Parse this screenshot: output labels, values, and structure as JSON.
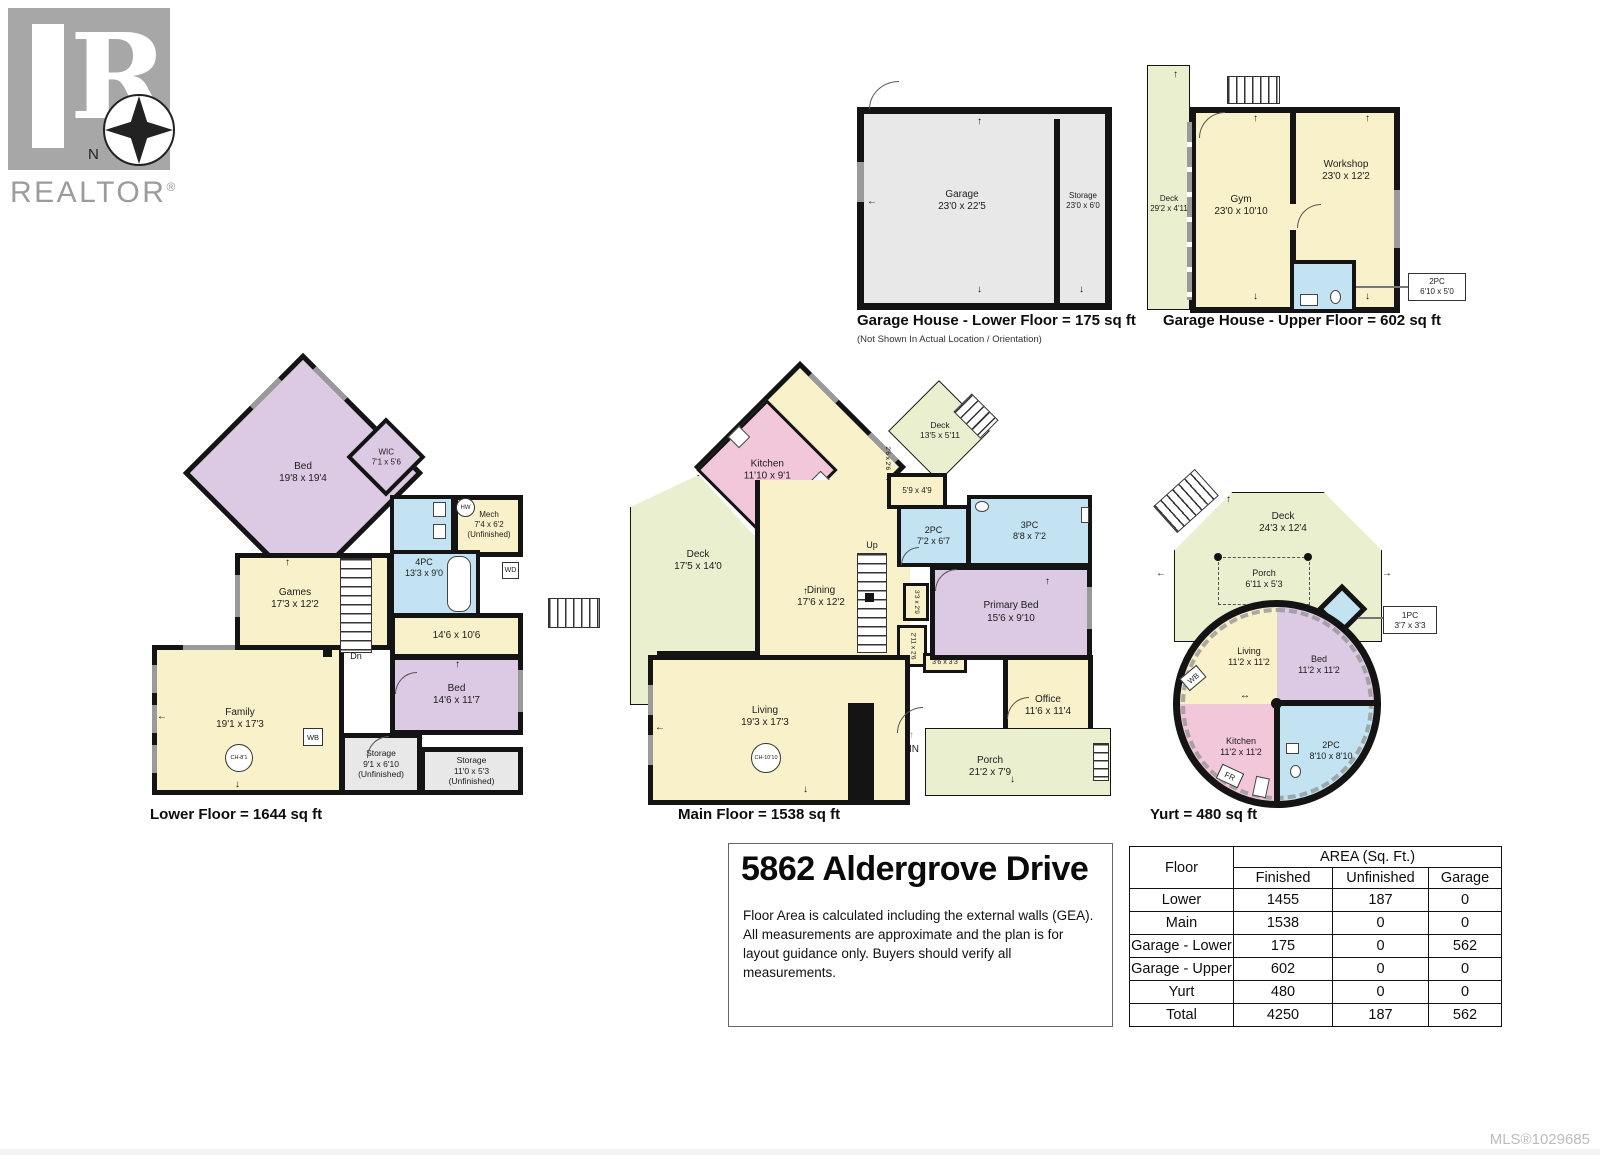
{
  "logo": {
    "brand": "REALTOR",
    "reg": "®",
    "north": "N"
  },
  "plans": {
    "garage_lower": {
      "caption": "Garage House - Lower Floor = 175 sq ft",
      "note": "(Not Shown In Actual Location / Orientation)",
      "rooms": [
        {
          "name": "Garage",
          "dims": "23'0 x 22'5"
        },
        {
          "name": "Storage",
          "dims": "23'0 x 6'0"
        }
      ]
    },
    "garage_upper": {
      "caption": "Garage House - Upper Floor = 602 sq ft",
      "rooms": [
        {
          "name": "Deck",
          "dims": "29'2 x 4'11"
        },
        {
          "name": "Gym",
          "dims": "23'0 x 10'10"
        },
        {
          "name": "Workshop",
          "dims": "23'0 x 12'2"
        }
      ],
      "callout": {
        "name": "2PC",
        "dims": "6'10 x 5'0"
      }
    },
    "lower": {
      "caption": "Lower Floor = 1644 sq ft",
      "rooms": [
        {
          "name": "Bed",
          "dims": "19'8 x 19'4"
        },
        {
          "name": "WIC",
          "dims": "7'1 x 5'6"
        },
        {
          "name": "Mech",
          "dims": "7'4 x 6'2",
          "note": "(Unfinished)"
        },
        {
          "name": "4PC",
          "dims": "13'3 x 9'0"
        },
        {
          "name": "",
          "dims": "14'6 x 10'6"
        },
        {
          "name": "Bed",
          "dims": "14'6 x 11'7"
        },
        {
          "name": "",
          "dims": "3'8 x 2'4"
        },
        {
          "name": "Storage",
          "dims": "9'1 x 6'10",
          "note": "(Unfinished)"
        },
        {
          "name": "Storage",
          "dims": "11'0 x 5'3",
          "note": "(Unfinished)"
        },
        {
          "name": "Family",
          "dims": "19'1 x 17'3"
        },
        {
          "name": "Games",
          "dims": "17'3 x 12'2"
        }
      ],
      "markers": {
        "dn": "Dn",
        "wb": "WB",
        "wd": "WD",
        "hw": "HW",
        "ch": "CH-8'1"
      }
    },
    "main": {
      "caption": "Main Floor = 1538 sq ft",
      "rooms": [
        {
          "name": "Kitchen",
          "dims": "11'10 x 9'1"
        },
        {
          "name": "Deck",
          "dims": "17'5 x 14'0"
        },
        {
          "name": "Deck",
          "dims": "13'5 x 5'11"
        },
        {
          "name": "",
          "dims": "5'9 x 4'9"
        },
        {
          "name": "2PC",
          "dims": "7'2 x 6'7"
        },
        {
          "name": "3PC",
          "dims": "8'8 x 7'2"
        },
        {
          "name": "Primary Bed",
          "dims": "15'6 x 9'10"
        },
        {
          "name": "Dining",
          "dims": "17'6 x 12'2"
        },
        {
          "name": "Living",
          "dims": "19'3 x 17'3"
        },
        {
          "name": "Office",
          "dims": "11'6 x 11'4"
        },
        {
          "name": "Porch",
          "dims": "21'2 x 7'9"
        }
      ],
      "small": [
        "2'6 x 2'6",
        "3'3 x 2'9",
        "2'11 x 2'6",
        "3'6 x 3'3"
      ],
      "markers": {
        "up": "Up",
        "fr": "FR",
        "in": "IN",
        "ch": "CH-10'10"
      }
    },
    "yurt": {
      "caption": "Yurt = 480 sq ft",
      "rooms": [
        {
          "name": "Deck",
          "dims": "24'3 x 12'4"
        },
        {
          "name": "Porch",
          "dims": "6'11 x 5'3"
        },
        {
          "name": "Living",
          "dims": "11'2 x 11'2"
        },
        {
          "name": "Bed",
          "dims": "11'2 x 11'2"
        },
        {
          "name": "Kitchen",
          "dims": "11'2 x 11'2"
        },
        {
          "name": "2PC",
          "dims": "8'10 x 8'10"
        }
      ],
      "callout": {
        "name": "1PC",
        "dims": "3'7 x 3'3"
      },
      "markers": {
        "wb": "WB",
        "fr": "FR"
      }
    }
  },
  "info": {
    "title": "5862 Aldergrove Drive",
    "disclaimer_lines": [
      "Floor Area is calculated including the external walls (GEA).",
      "All measurements are approximate and the plan is for",
      "layout guidance only. Buyers should verify all measurements."
    ]
  },
  "table": {
    "floor_header": "Floor",
    "area_header": "AREA (Sq. Ft.)",
    "cols": [
      "Finished",
      "Unfinished",
      "Garage"
    ],
    "rows": [
      {
        "floor": "Lower",
        "finished": "1455",
        "unfinished": "187",
        "garage": "0"
      },
      {
        "floor": "Main",
        "finished": "1538",
        "unfinished": "0",
        "garage": "0"
      },
      {
        "floor": "Garage - Lower",
        "finished": "175",
        "unfinished": "0",
        "garage": "562"
      },
      {
        "floor": "Garage - Upper",
        "finished": "602",
        "unfinished": "0",
        "garage": "0"
      },
      {
        "floor": "Yurt",
        "finished": "480",
        "unfinished": "0",
        "garage": "0"
      },
      {
        "floor": "Total",
        "finished": "4250",
        "unfinished": "187",
        "garage": "562"
      }
    ]
  },
  "footer": {
    "mls": "MLS®1029685"
  }
}
